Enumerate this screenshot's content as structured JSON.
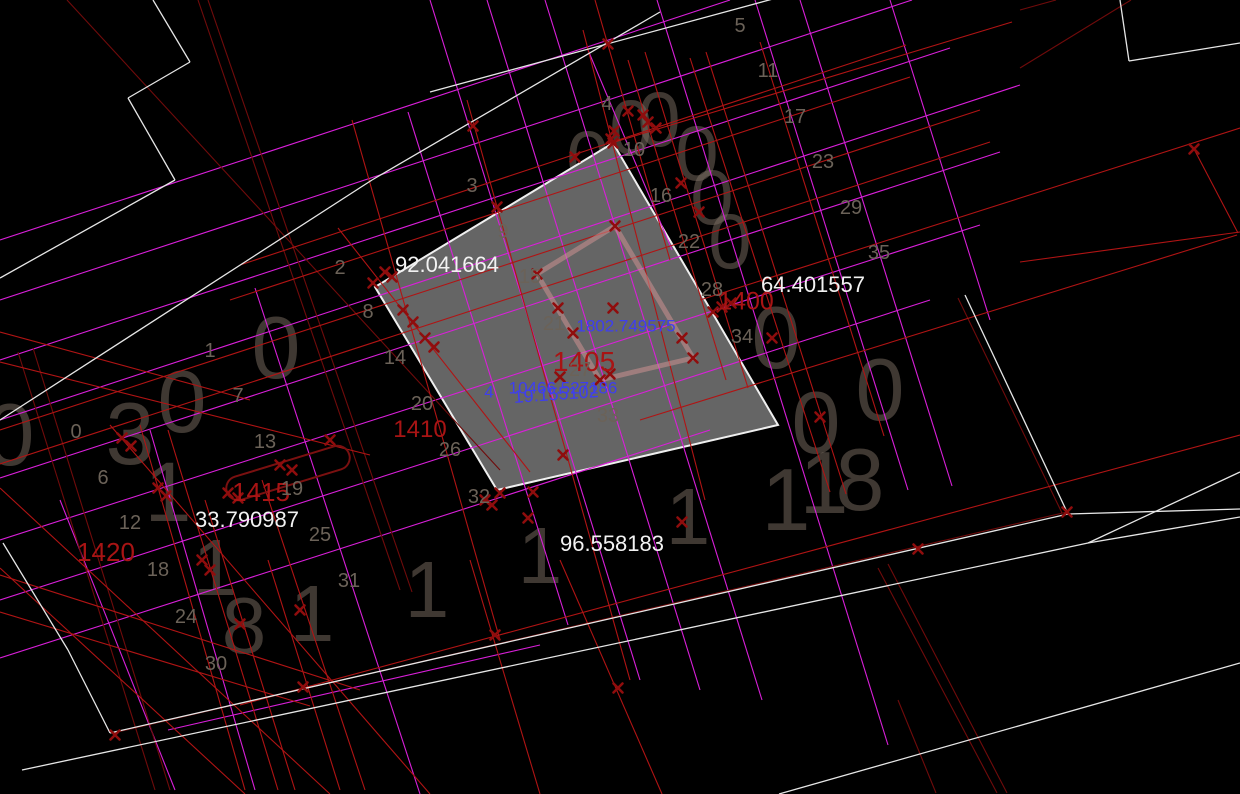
{
  "canvas": {
    "colors": {
      "background": "#000000",
      "white_line": "#e6e6e6",
      "red_line": "#b01414",
      "darkred_line": "#700b0b",
      "magenta_line": "#d91fd9",
      "marker": "#8f0d0d",
      "parcel_fill": "#656565",
      "parcel_border": "#efefef",
      "inner_rect_stroke": "rgba(205,145,145,0.55)",
      "stadium_stroke": "#7a1010",
      "measure_text": "#f2f2f2",
      "station_text": "#a81414",
      "coord_text": "#3e3ef0",
      "gridnum_text": "#6b6258"
    },
    "parcel": {
      "points": [
        [
          613,
          143
        ],
        [
          778,
          425
        ],
        [
          497,
          490
        ],
        [
          375,
          287
        ]
      ]
    },
    "inner_rect": {
      "points": [
        [
          615,
          226
        ],
        [
          537,
          274
        ],
        [
          600,
          380
        ],
        [
          693,
          358
        ]
      ]
    },
    "stadium": {
      "cx": 288,
      "cy": 473,
      "w": 128,
      "h": 24,
      "angle": -17
    },
    "lines": [
      {
        "x1": 0,
        "y1": 240,
        "x2": 730,
        "y2": 0,
        "c": "m"
      },
      {
        "x1": 0,
        "y1": 300,
        "x2": 912,
        "y2": 0,
        "c": "m"
      },
      {
        "x1": 0,
        "y1": 360,
        "x2": 950,
        "y2": 48,
        "c": "m"
      },
      {
        "x1": 0,
        "y1": 420,
        "x2": 1020,
        "y2": 85,
        "c": "m"
      },
      {
        "x1": 0,
        "y1": 478,
        "x2": 1000,
        "y2": 152,
        "c": "m"
      },
      {
        "x1": 0,
        "y1": 540,
        "x2": 980,
        "y2": 225,
        "c": "m"
      },
      {
        "x1": 0,
        "y1": 600,
        "x2": 930,
        "y2": 300,
        "c": "m"
      },
      {
        "x1": 0,
        "y1": 658,
        "x2": 710,
        "y2": 430,
        "c": "m"
      },
      {
        "x1": 168,
        "y1": 730,
        "x2": 540,
        "y2": 645,
        "c": "m"
      },
      {
        "x1": 430,
        "y1": 0,
        "x2": 640,
        "y2": 680,
        "c": "m"
      },
      {
        "x1": 487,
        "y1": 0,
        "x2": 700,
        "y2": 690,
        "c": "m"
      },
      {
        "x1": 545,
        "y1": 0,
        "x2": 762,
        "y2": 700,
        "c": "m"
      },
      {
        "x1": 657,
        "y1": 0,
        "x2": 888,
        "y2": 745,
        "c": "m"
      },
      {
        "x1": 255,
        "y1": 288,
        "x2": 420,
        "y2": 794,
        "c": "m"
      },
      {
        "x1": 150,
        "y1": 430,
        "x2": 255,
        "y2": 790,
        "c": "m"
      },
      {
        "x1": 60,
        "y1": 500,
        "x2": 175,
        "y2": 790,
        "c": "m"
      },
      {
        "x1": 408,
        "y1": 112,
        "x2": 568,
        "y2": 625,
        "c": "m"
      },
      {
        "x1": 890,
        "y1": 0,
        "x2": 990,
        "y2": 320,
        "c": "m"
      },
      {
        "x1": 755,
        "y1": 0,
        "x2": 908,
        "y2": 490,
        "c": "m"
      },
      {
        "x1": 800,
        "y1": 0,
        "x2": 952,
        "y2": 486,
        "c": "m"
      },
      {
        "x1": 588,
        "y1": 50,
        "x2": 672,
        "y2": 250,
        "c": "m"
      },
      {
        "x1": 198,
        "y1": 0,
        "x2": 400,
        "y2": 590,
        "c": "d"
      },
      {
        "x1": 208,
        "y1": 0,
        "x2": 412,
        "y2": 592,
        "c": "d"
      },
      {
        "x1": 67,
        "y1": 0,
        "x2": 500,
        "y2": 470,
        "c": "d"
      },
      {
        "x1": 1020,
        "y1": 10,
        "x2": 1056,
        "y2": 0,
        "c": "d"
      },
      {
        "x1": 1020,
        "y1": 68,
        "x2": 1131,
        "y2": 0,
        "c": "d"
      },
      {
        "x1": 113,
        "y1": 733,
        "x2": 1067,
        "y2": 512,
        "c": "d"
      },
      {
        "x1": 958,
        "y1": 298,
        "x2": 1062,
        "y2": 513,
        "c": "d"
      },
      {
        "x1": 878,
        "y1": 568,
        "x2": 997,
        "y2": 793,
        "c": "d"
      },
      {
        "x1": 888,
        "y1": 564,
        "x2": 1007,
        "y2": 793,
        "c": "d"
      },
      {
        "x1": 898,
        "y1": 700,
        "x2": 936,
        "y2": 793,
        "c": "d"
      },
      {
        "x1": 18,
        "y1": 352,
        "x2": 155,
        "y2": 790,
        "c": "d"
      },
      {
        "x1": 33,
        "y1": 348,
        "x2": 170,
        "y2": 790,
        "c": "d"
      },
      {
        "x1": 595,
        "y1": 0,
        "x2": 670,
        "y2": 260,
        "c": "r"
      },
      {
        "x1": 240,
        "y1": 265,
        "x2": 906,
        "y2": 45,
        "c": "r"
      },
      {
        "x1": 230,
        "y1": 300,
        "x2": 910,
        "y2": 77,
        "c": "r"
      },
      {
        "x1": 0,
        "y1": 430,
        "x2": 980,
        "y2": 110,
        "c": "r"
      },
      {
        "x1": 0,
        "y1": 464,
        "x2": 990,
        "y2": 142,
        "c": "r"
      },
      {
        "x1": 467,
        "y1": 100,
        "x2": 630,
        "y2": 680,
        "c": "r"
      },
      {
        "x1": 583,
        "y1": 30,
        "x2": 705,
        "y2": 500,
        "c": "r"
      },
      {
        "x1": 628,
        "y1": 60,
        "x2": 726,
        "y2": 380,
        "c": "r"
      },
      {
        "x1": 645,
        "y1": 52,
        "x2": 748,
        "y2": 388,
        "c": "r"
      },
      {
        "x1": 690,
        "y1": 58,
        "x2": 830,
        "y2": 492,
        "c": "r"
      },
      {
        "x1": 706,
        "y1": 52,
        "x2": 846,
        "y2": 494,
        "c": "r"
      },
      {
        "x1": 760,
        "y1": 42,
        "x2": 884,
        "y2": 436,
        "c": "r"
      },
      {
        "x1": 608,
        "y1": 144,
        "x2": 1012,
        "y2": 22,
        "c": "r"
      },
      {
        "x1": 700,
        "y1": 300,
        "x2": 1240,
        "y2": 128,
        "c": "r"
      },
      {
        "x1": 640,
        "y1": 420,
        "x2": 1237,
        "y2": 235,
        "c": "r"
      },
      {
        "x1": 1020,
        "y1": 262,
        "x2": 1240,
        "y2": 232,
        "c": "r"
      },
      {
        "x1": 1194,
        "y1": 149,
        "x2": 1238,
        "y2": 233,
        "c": "r"
      },
      {
        "x1": 240,
        "y1": 705,
        "x2": 1240,
        "y2": 435,
        "c": "r"
      },
      {
        "x1": 0,
        "y1": 575,
        "x2": 360,
        "y2": 690,
        "c": "r"
      },
      {
        "x1": 0,
        "y1": 612,
        "x2": 310,
        "y2": 706,
        "c": "r"
      },
      {
        "x1": 0,
        "y1": 488,
        "x2": 330,
        "y2": 794,
        "c": "r"
      },
      {
        "x1": 0,
        "y1": 568,
        "x2": 245,
        "y2": 794,
        "c": "r"
      },
      {
        "x1": 110,
        "y1": 425,
        "x2": 430,
        "y2": 794,
        "c": "r"
      },
      {
        "x1": 470,
        "y1": 560,
        "x2": 540,
        "y2": 794,
        "c": "r"
      },
      {
        "x1": 560,
        "y1": 560,
        "x2": 662,
        "y2": 794,
        "c": "r"
      },
      {
        "x1": 338,
        "y1": 228,
        "x2": 530,
        "y2": 472,
        "c": "r"
      },
      {
        "x1": 0,
        "y1": 362,
        "x2": 370,
        "y2": 455,
        "c": "r"
      },
      {
        "x1": 0,
        "y1": 332,
        "x2": 250,
        "y2": 400,
        "c": "r"
      },
      {
        "x1": 140,
        "y1": 425,
        "x2": 245,
        "y2": 790,
        "c": "r"
      },
      {
        "x1": 168,
        "y1": 430,
        "x2": 278,
        "y2": 790,
        "c": "r"
      },
      {
        "x1": 205,
        "y1": 500,
        "x2": 295,
        "y2": 790,
        "c": "r"
      },
      {
        "x1": 262,
        "y1": 480,
        "x2": 365,
        "y2": 790,
        "c": "r"
      },
      {
        "x1": 268,
        "y1": 560,
        "x2": 340,
        "y2": 790,
        "c": "r"
      },
      {
        "x1": 352,
        "y1": 120,
        "x2": 500,
        "y2": 640,
        "c": "r"
      },
      {
        "x1": 153,
        "y1": 0,
        "x2": 190,
        "y2": 62,
        "c": "w"
      },
      {
        "x1": 190,
        "y1": 62,
        "x2": 128,
        "y2": 98,
        "c": "w"
      },
      {
        "x1": 128,
        "y1": 98,
        "x2": 175,
        "y2": 180,
        "c": "w"
      },
      {
        "x1": 175,
        "y1": 180,
        "x2": 0,
        "y2": 278,
        "c": "w"
      },
      {
        "x1": 0,
        "y1": 420,
        "x2": 372,
        "y2": 180,
        "c": "w"
      },
      {
        "x1": 372,
        "y1": 180,
        "x2": 660,
        "y2": 12,
        "c": "w"
      },
      {
        "x1": 430,
        "y1": 92,
        "x2": 806,
        "y2": -10,
        "c": "w"
      },
      {
        "x1": 1120,
        "y1": 0,
        "x2": 1129,
        "y2": 61,
        "c": "w"
      },
      {
        "x1": 1129,
        "y1": 61,
        "x2": 1240,
        "y2": 43,
        "c": "w"
      },
      {
        "x1": 3,
        "y1": 543,
        "x2": 68,
        "y2": 650,
        "c": "w"
      },
      {
        "x1": 68,
        "y1": 650,
        "x2": 110,
        "y2": 733,
        "c": "w"
      },
      {
        "x1": 110,
        "y1": 733,
        "x2": 1068,
        "y2": 514,
        "c": "w"
      },
      {
        "x1": 1068,
        "y1": 514,
        "x2": 1240,
        "y2": 509,
        "c": "w"
      },
      {
        "x1": 22,
        "y1": 770,
        "x2": 1088,
        "y2": 543,
        "c": "w"
      },
      {
        "x1": 1088,
        "y1": 543,
        "x2": 1240,
        "y2": 517,
        "c": "w"
      },
      {
        "x1": 1088,
        "y1": 543,
        "x2": 1240,
        "y2": 472,
        "c": "w"
      },
      {
        "x1": 965,
        "y1": 295,
        "x2": 1068,
        "y2": 514,
        "c": "w"
      },
      {
        "x1": 779,
        "y1": 794,
        "x2": 1240,
        "y2": 663,
        "c": "w"
      }
    ],
    "markers": [
      [
        608,
        44
      ],
      [
        473,
        126
      ],
      [
        497,
        207
      ],
      [
        575,
        157
      ],
      [
        613,
        143
      ],
      [
        614,
        131
      ],
      [
        611,
        139
      ],
      [
        628,
        111
      ],
      [
        643,
        115
      ],
      [
        648,
        122
      ],
      [
        656,
        128
      ],
      [
        681,
        183
      ],
      [
        699,
        212
      ],
      [
        713,
        312
      ],
      [
        722,
        307
      ],
      [
        731,
        303
      ],
      [
        772,
        338
      ],
      [
        820,
        417
      ],
      [
        373,
        283
      ],
      [
        385,
        272
      ],
      [
        392,
        277
      ],
      [
        403,
        310
      ],
      [
        413,
        322
      ],
      [
        425,
        338
      ],
      [
        434,
        347
      ],
      [
        615,
        226
      ],
      [
        537,
        274
      ],
      [
        558,
        308
      ],
      [
        573,
        333
      ],
      [
        600,
        380
      ],
      [
        610,
        374
      ],
      [
        682,
        338
      ],
      [
        693,
        358
      ],
      [
        613,
        308
      ],
      [
        560,
        377
      ],
      [
        122,
        438
      ],
      [
        131,
        446
      ],
      [
        158,
        488
      ],
      [
        166,
        496
      ],
      [
        202,
        560
      ],
      [
        210,
        570
      ],
      [
        240,
        624
      ],
      [
        300,
        610
      ],
      [
        303,
        687
      ],
      [
        115,
        735
      ],
      [
        228,
        493
      ],
      [
        238,
        498
      ],
      [
        280,
        465
      ],
      [
        292,
        470
      ],
      [
        330,
        440
      ],
      [
        485,
        500
      ],
      [
        492,
        505
      ],
      [
        500,
        493
      ],
      [
        533,
        492
      ],
      [
        528,
        518
      ],
      [
        563,
        455
      ],
      [
        682,
        522
      ],
      [
        495,
        635
      ],
      [
        618,
        688
      ],
      [
        918,
        549
      ],
      [
        1067,
        512
      ],
      [
        1194,
        149
      ]
    ],
    "labels": {
      "measurements": [
        {
          "t": "92.041664",
          "x": 447,
          "y": 265,
          "s": 22
        },
        {
          "t": "64.401557",
          "x": 813,
          "y": 285,
          "s": 22
        },
        {
          "t": "33.790987",
          "x": 247,
          "y": 520,
          "s": 22
        },
        {
          "t": "96.558183",
          "x": 612,
          "y": 544,
          "s": 22
        }
      ],
      "station_labels": [
        {
          "t": "1400",
          "x": 746,
          "y": 302,
          "s": 25
        },
        {
          "t": "1405",
          "x": 584,
          "y": 362,
          "s": 28
        },
        {
          "t": "1410",
          "x": 420,
          "y": 430,
          "s": 24
        },
        {
          "t": "1415",
          "x": 261,
          "y": 492,
          "s": 26
        },
        {
          "t": "1420",
          "x": 106,
          "y": 552,
          "s": 26
        }
      ],
      "coordinate_labels": [
        {
          "t": "1802.749575",
          "x": 626,
          "y": 326,
          "s": 17
        },
        {
          "t": "10466.527186",
          "x": 563,
          "y": 388,
          "s": 17
        },
        {
          "t": "19.155102",
          "x": 556,
          "y": 394,
          "s": 18,
          "rot": -4
        },
        {
          "t": "4",
          "x": 489,
          "y": 392,
          "s": 17
        }
      ],
      "grid_numbers": [
        {
          "t": "0",
          "x": 76,
          "y": 432
        },
        {
          "t": "6",
          "x": 103,
          "y": 478
        },
        {
          "t": "12",
          "x": 130,
          "y": 523
        },
        {
          "t": "18",
          "x": 158,
          "y": 570
        },
        {
          "t": "24",
          "x": 186,
          "y": 617
        },
        {
          "t": "30",
          "x": 216,
          "y": 664
        },
        {
          "t": "1",
          "x": 210,
          "y": 351
        },
        {
          "t": "7",
          "x": 238,
          "y": 396
        },
        {
          "t": "13",
          "x": 265,
          "y": 442
        },
        {
          "t": "19",
          "x": 292,
          "y": 489
        },
        {
          "t": "25",
          "x": 320,
          "y": 535
        },
        {
          "t": "31",
          "x": 349,
          "y": 581
        },
        {
          "t": "2",
          "x": 340,
          "y": 268
        },
        {
          "t": "8",
          "x": 368,
          "y": 312
        },
        {
          "t": "14",
          "x": 395,
          "y": 358
        },
        {
          "t": "20",
          "x": 422,
          "y": 404
        },
        {
          "t": "26",
          "x": 450,
          "y": 450
        },
        {
          "t": "32",
          "x": 479,
          "y": 497
        },
        {
          "t": "3",
          "x": 472,
          "y": 186
        },
        {
          "t": "9",
          "x": 503,
          "y": 232
        },
        {
          "t": "15",
          "x": 530,
          "y": 277
        },
        {
          "t": "21",
          "x": 554,
          "y": 324
        },
        {
          "t": "27",
          "x": 580,
          "y": 370
        },
        {
          "t": "33",
          "x": 608,
          "y": 416
        },
        {
          "t": "4",
          "x": 607,
          "y": 104
        },
        {
          "t": "10",
          "x": 634,
          "y": 150
        },
        {
          "t": "16",
          "x": 661,
          "y": 196
        },
        {
          "t": "22",
          "x": 689,
          "y": 242
        },
        {
          "t": "28",
          "x": 712,
          "y": 290
        },
        {
          "t": "34",
          "x": 742,
          "y": 337
        },
        {
          "t": "5",
          "x": 740,
          "y": 26
        },
        {
          "t": "11",
          "x": 768,
          "y": 71
        },
        {
          "t": "17",
          "x": 795,
          "y": 117
        },
        {
          "t": "23",
          "x": 823,
          "y": 162
        },
        {
          "t": "29",
          "x": 851,
          "y": 208
        },
        {
          "t": "35",
          "x": 879,
          "y": 253
        }
      ],
      "ghost_digits": [
        {
          "t": "0",
          "x": 588,
          "y": 158,
          "s": 78
        },
        {
          "t": "0",
          "x": 631,
          "y": 127,
          "s": 78
        },
        {
          "t": "0",
          "x": 659,
          "y": 119,
          "s": 78
        },
        {
          "t": "0",
          "x": 697,
          "y": 153,
          "s": 78
        },
        {
          "t": "0",
          "x": 712,
          "y": 197,
          "s": 78
        },
        {
          "t": "0",
          "x": 730,
          "y": 241,
          "s": 78
        },
        {
          "t": "0",
          "x": 776,
          "y": 338,
          "s": 88
        },
        {
          "t": "0",
          "x": 816,
          "y": 423,
          "s": 88
        },
        {
          "t": "0",
          "x": 880,
          "y": 390,
          "s": 88
        },
        {
          "t": "1",
          "x": 786,
          "y": 500,
          "s": 88
        },
        {
          "t": "1",
          "x": 824,
          "y": 483,
          "s": 88
        },
        {
          "t": "8",
          "x": 860,
          "y": 480,
          "s": 88
        },
        {
          "t": "1",
          "x": 540,
          "y": 556,
          "s": 80
        },
        {
          "t": "1",
          "x": 688,
          "y": 517,
          "s": 80
        },
        {
          "t": "1",
          "x": 427,
          "y": 590,
          "s": 80
        },
        {
          "t": "0",
          "x": 276,
          "y": 348,
          "s": 88
        },
        {
          "t": "0",
          "x": 182,
          "y": 402,
          "s": 88
        },
        {
          "t": "3",
          "x": 130,
          "y": 434,
          "s": 88
        },
        {
          "t": "1",
          "x": 168,
          "y": 492,
          "s": 84
        },
        {
          "t": "1",
          "x": 215,
          "y": 568,
          "s": 80
        },
        {
          "t": "8",
          "x": 244,
          "y": 626,
          "s": 80
        },
        {
          "t": "1",
          "x": 312,
          "y": 614,
          "s": 80
        },
        {
          "t": "0",
          "x": 10,
          "y": 435,
          "s": 88
        },
        {
          "t": "4",
          "x": 505,
          "y": 275,
          "s": 34
        }
      ]
    }
  }
}
